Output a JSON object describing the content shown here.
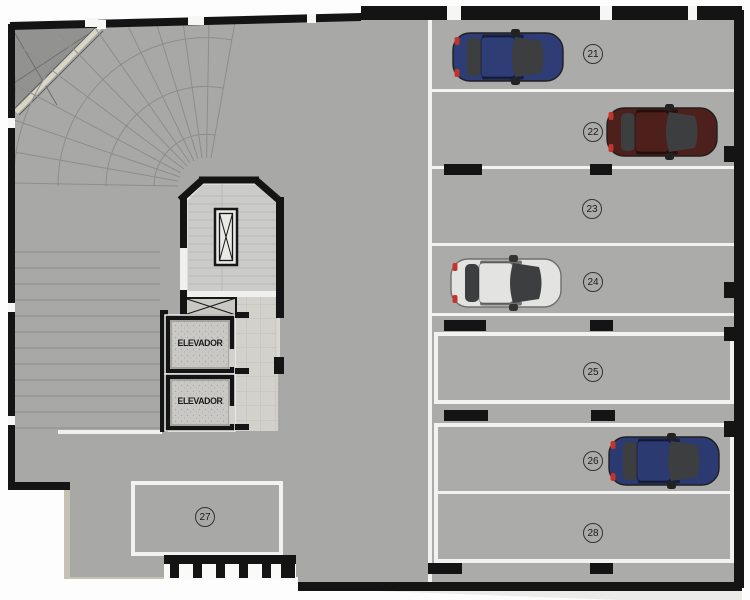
{
  "scene": {
    "type": "parking-garage-floor-plan",
    "language": "Portuguese"
  },
  "colors": {
    "floor": "#a8a8a6",
    "stall_floor": "#ababa9",
    "wall": "#141414",
    "marking_white": "#f2f2f0",
    "ramp_line": "#8d8d8b",
    "ramp_triangle": "#929290",
    "ramp_barrier": "#d9d5c5",
    "stair_floor": "#cbcbc9",
    "lobby_tile": "#d2d1cb",
    "elevator_floor": "#c9c8c4",
    "curb": "#c6c2b2",
    "sidewalk": "#ebebe9",
    "car_glass": "#3c3e40",
    "badge_ring": "#333333"
  },
  "elevators": [
    {
      "label": "ELEVADOR"
    },
    {
      "label": "ELEVADOR"
    }
  ],
  "parking_spaces": [
    {
      "number": "21",
      "occupied": true,
      "car_color": "#2f3d76"
    },
    {
      "number": "22",
      "occupied": true,
      "car_color": "#4d201b"
    },
    {
      "number": "23",
      "occupied": false
    },
    {
      "number": "24",
      "occupied": true,
      "car_color": "#e3e3e1"
    },
    {
      "number": "25",
      "occupied": false
    },
    {
      "number": "26",
      "occupied": true,
      "car_color": "#2c3a72"
    },
    {
      "number": "27",
      "occupied": false
    },
    {
      "number": "28",
      "occupied": false
    }
  ]
}
